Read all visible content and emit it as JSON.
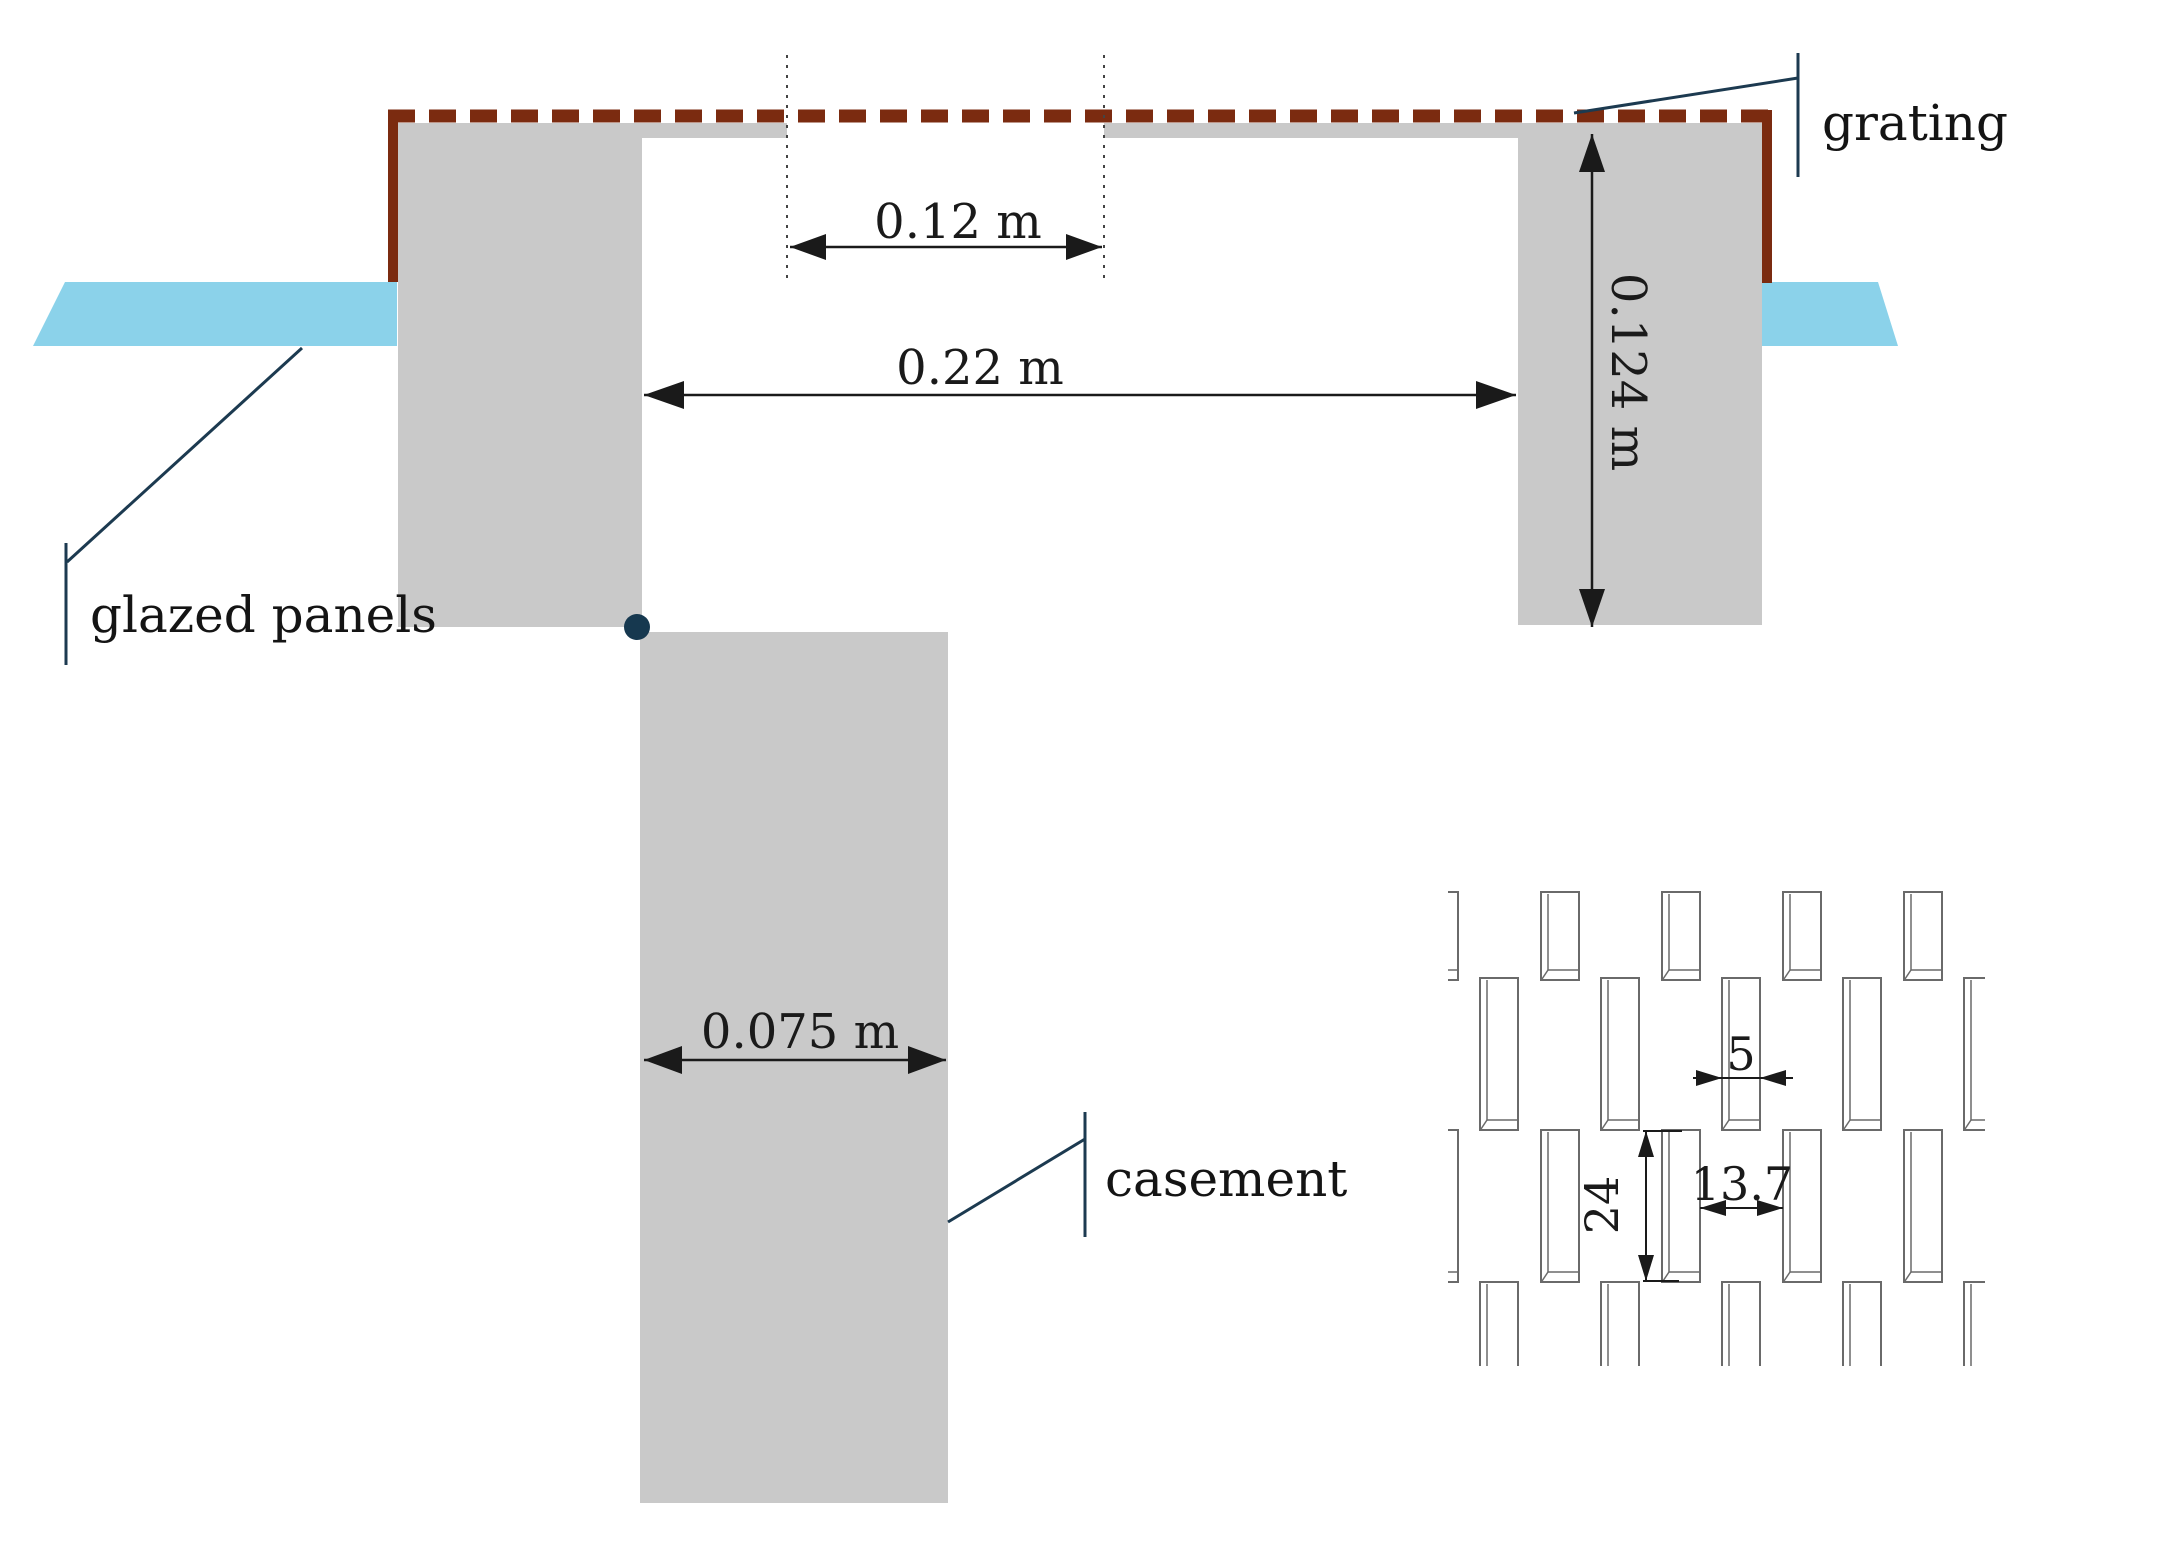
{
  "diagram": {
    "title_labels": {
      "grating": "grating",
      "glazed_panels": "glazed panels",
      "casement": "casement"
    },
    "dimensions": {
      "grating_opening": "0.12 m",
      "cavity_width": "0.22 m",
      "frame_height": "0.124 m",
      "casement_width": "0.075 m"
    },
    "detail_dimensions": {
      "slot_width": "5",
      "slot_height": "24",
      "slot_gap": "13.7"
    },
    "colors": {
      "panel_blue": "#8BD2EA",
      "frame_gray": "#C9C9C9",
      "grating_red": "#7B2B10",
      "callout_navy": "#1C3A50",
      "pivot_dot": "#16384F"
    }
  }
}
